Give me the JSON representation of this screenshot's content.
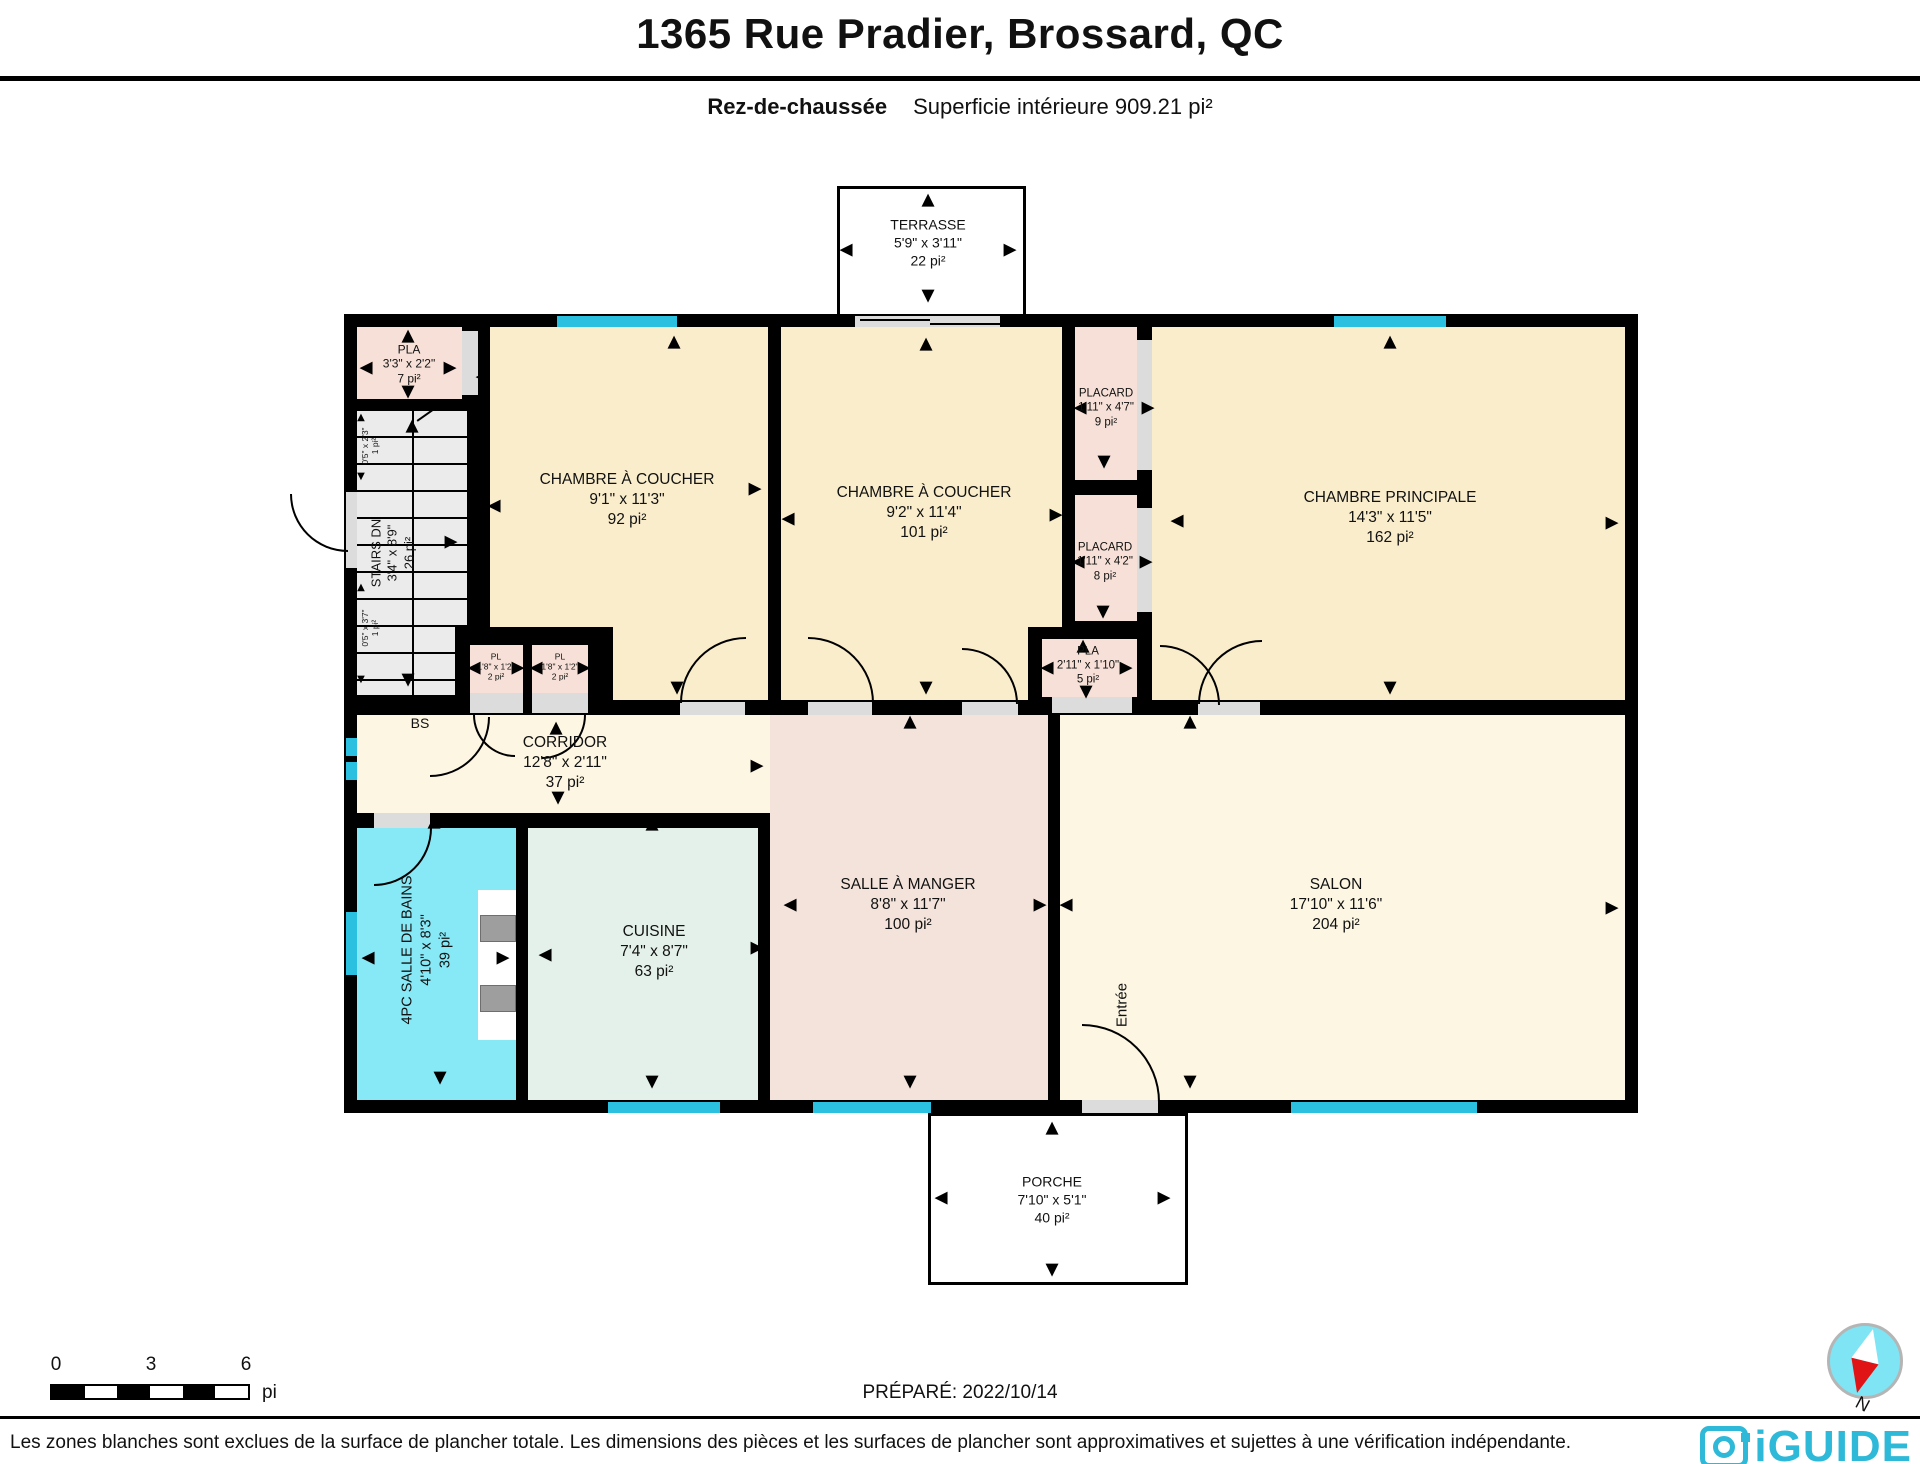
{
  "header": {
    "title": "1365 Rue Pradier, Brossard, QC",
    "floor_label": "Rez-de-chaussée",
    "area_label": "Superficie intérieure 909.21 pi²"
  },
  "rooms": [
    {
      "id": "terrasse",
      "name": "TERRASSE",
      "dims": "5'9\" x 3'11\"",
      "area": "22 pi²"
    },
    {
      "id": "pla_top",
      "name": "PLA",
      "dims": "3'3\" x 2'2\"",
      "area": "7 pi²"
    },
    {
      "id": "stairs",
      "name": "STAIRS DN",
      "dims": "3'4\" x 8'9\"",
      "area": "26 pi²"
    },
    {
      "id": "bedroom1",
      "name": "CHAMBRE À COUCHER",
      "dims": "9'1\" x 11'3\"",
      "area": "92 pi²"
    },
    {
      "id": "bedroom2",
      "name": "CHAMBRE À COUCHER",
      "dims": "9'2\" x 11'4\"",
      "area": "101 pi²"
    },
    {
      "id": "placard1",
      "name": "PLACARD",
      "dims": "1'11\" x 4'7\"",
      "area": "9 pi²"
    },
    {
      "id": "placard2",
      "name": "PLACARD",
      "dims": "1'11\" x 4'2\"",
      "area": "8 pi²"
    },
    {
      "id": "master",
      "name": "CHAMBRE PRINCIPALE",
      "dims": "14'3\" x 11'5\"",
      "area": "162 pi²"
    },
    {
      "id": "pla_mid",
      "name": "PLA",
      "dims": "2'11\" x 1'10\"",
      "area": "5 pi²"
    },
    {
      "id": "pl_a",
      "name": "PL",
      "dims": "1'8\" x 1'2\"",
      "area": "2 pi²"
    },
    {
      "id": "pl_b",
      "name": "PL",
      "dims": "1'8\" x 1'2\"",
      "area": "2 pi²"
    },
    {
      "id": "corridor",
      "name": "CORRIDOR",
      "dims": "12'8\" x 2'11\"",
      "area": "37 pi²"
    },
    {
      "id": "cuisine",
      "name": "CUISINE",
      "dims": "7'4\" x 8'7\"",
      "area": "63 pi²"
    },
    {
      "id": "dining",
      "name": "SALLE À MANGER",
      "dims": "8'8\" x 11'7\"",
      "area": "100 pi²"
    },
    {
      "id": "salon",
      "name": "SALON",
      "dims": "17'10\" x 11'6\"",
      "area": "204 pi²"
    },
    {
      "id": "bathroom",
      "name": "4PC SALLE DE BAINS",
      "dims": "4'10\" x 8'3\"",
      "area": "39 pi²"
    },
    {
      "id": "porche",
      "name": "PORCHE",
      "dims": "7'10\" x 5'1\"",
      "area": "40 pi²"
    }
  ],
  "annotations": {
    "entree": "Entrée",
    "bs": "BS",
    "niche_top_dims": "0'5\" x 2'3\"",
    "niche_top_area": "1 pi²",
    "niche_bottom_dims": "0'5\" x 3'7\"",
    "niche_bottom_area": "1 pi²",
    "north": "N"
  },
  "footer": {
    "scale_0": "0",
    "scale_3": "3",
    "scale_6": "6",
    "scale_unit": "pi",
    "prepared": "PRÉPARÉ: 2022/10/14",
    "disclaimer": "Les zones blanches sont exclues de la surface de plancher totale. Les dimensions des pièces et les surfaces de plancher sont approximatives et sujettes à une vérification indépendante.",
    "brand": "iGUIDE"
  },
  "icons": {
    "u": "▲",
    "d": "▼",
    "l": "◀",
    "r": "▶"
  },
  "colors": {
    "wall": "#000000",
    "window_fill": "#2BC0DF",
    "bedroom_fill": "#FAEDCB",
    "living_fill": "#FCF6E2",
    "dining_fill": "#F4E3DB",
    "closet_fill": "#F7E0D7",
    "kitchen_fill": "#E4F1EA",
    "bath_fill": "#87E8F6",
    "stairs_fill": "#EBEBEB",
    "door_fill": "#DCDCDC",
    "brand": "#2FB9D8",
    "compass_fill": "#7FE4F3",
    "compass_red": "#E01414"
  }
}
